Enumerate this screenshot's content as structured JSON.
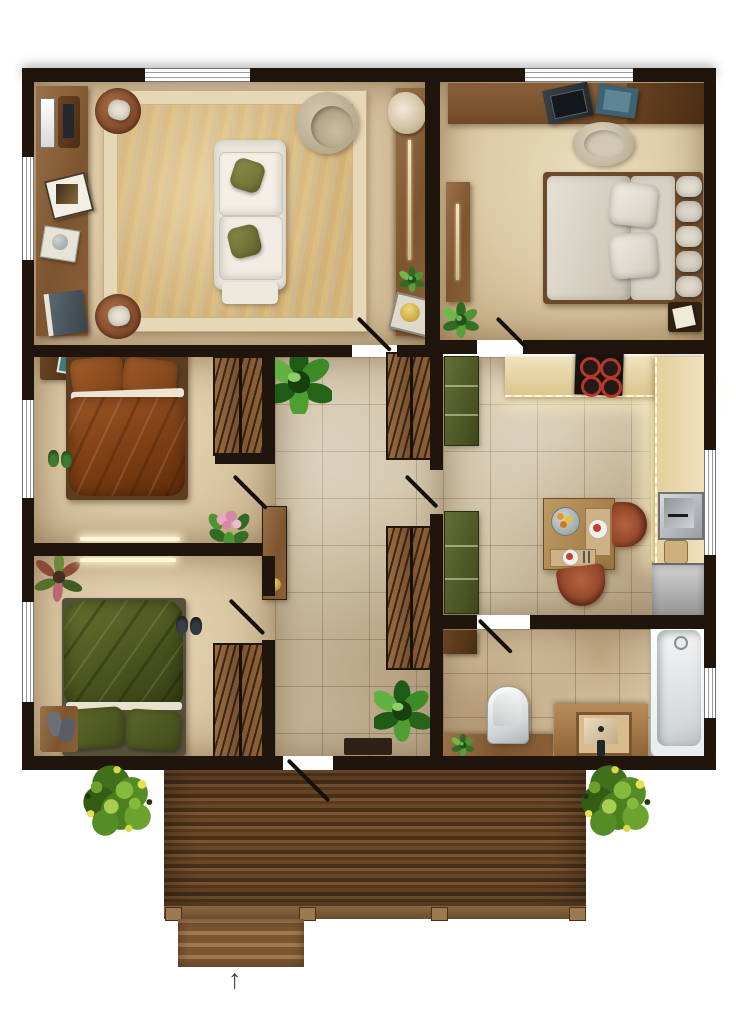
{
  "diagram": {
    "type": "floor-plan",
    "view": "top-down",
    "entry_arrow_glyph": "↑",
    "door_count": 7,
    "window_count": 7,
    "rooms": [
      {
        "name": "living-room",
        "furniture": [
          "area rug",
          "white sofa with two green pillows",
          "two brown armchairs with white cushions",
          "round papasan chair",
          "media sideboard with tv, frames, plant, books",
          "tall cabinet with long handle, succulent and gold tray"
        ]
      },
      {
        "name": "bedroom-top-right",
        "furniture": [
          "desk with laptop and blue folders",
          "round desk chair",
          "double bed with grey bedding, two pillows and headboard cushion row",
          "dark nightstand with papers",
          "wardrobe panel with long handle",
          "floor plant"
        ]
      },
      {
        "name": "bedroom-middle-left",
        "furniture": [
          "double bed with rust-brown bedding",
          "nightstand with teal photo frame",
          "green slippers",
          "hatched sliding wardrobe",
          "pink flower plant"
        ]
      },
      {
        "name": "bedroom-bottom-left",
        "furniture": [
          "double bed with green bedding",
          "red-green plant",
          "dark slippers",
          "bench with grey boots",
          "hatched sliding wardrobe"
        ]
      },
      {
        "name": "kitchen-dining",
        "furniture": [
          "l-shaped counter with under-cabinet glow",
          "cooktop with four red burners",
          "stainless sink",
          "stainless dishwasher",
          "two olive-green cabinets",
          "square dining table with fruit bowl and two place settings",
          "two terracotta chairs"
        ]
      },
      {
        "name": "bathroom",
        "furniture": [
          "bathtub",
          "wood vanity with basin and faucet",
          "toilet",
          "low bench with small plant",
          "dark cabinet"
        ]
      },
      {
        "name": "hallway",
        "furniture": [
          "two hatched wardrobes",
          "tall console with gold dish",
          "large green plants",
          "doormat",
          "wall light strips"
        ]
      },
      {
        "name": "deck",
        "furniture": [
          "horizontal wood planks",
          "entry steps",
          "two bushes",
          "four posts"
        ]
      }
    ],
    "palette": {
      "wall": "#1f150d",
      "floor_beige": "#dcc9a6",
      "tile": "#cfc0a3",
      "deck_wood": "#5e3f24",
      "bed_brown": "#8a4a20",
      "bed_green": "#4f5a24",
      "bed_grey": "#d8d2c6",
      "counter": "#e9d8ae",
      "terracotta": "#a14e34",
      "cabinet_green": "#56602e",
      "bath_white": "#f4f6f6"
    }
  }
}
